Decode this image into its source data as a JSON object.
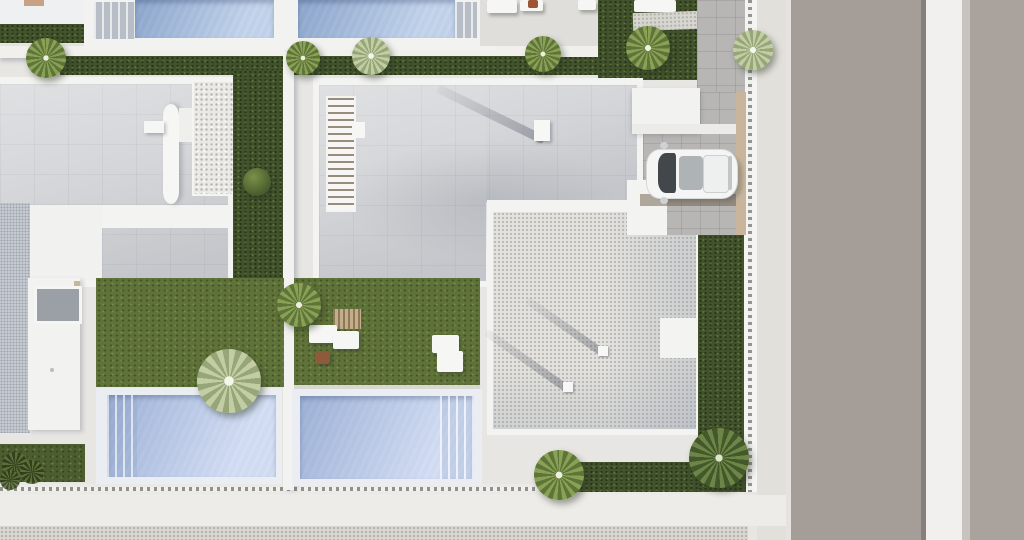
{
  "meta": {
    "title": "Aerial top-down 3D architectural rendering of modern villas with pools, gardens, driveway and street",
    "view": "top-down aerial",
    "render_style": "photorealistic 3D site render"
  },
  "palette": {
    "base": "#e7e6e3",
    "parapet": "#f3f3f1",
    "roof": "#d5d6d9",
    "pool_top": "#a3bcdf",
    "pool_bottom": "#bccced",
    "pool_rim": "#eaedf1",
    "pool_deck": "#c6c9ce",
    "grass": "#5f7239",
    "grass_dark": "#4c5e2f",
    "hedge": "#41522c",
    "road": "#a59d98",
    "road_far": "#aaa29d",
    "median": "#f1f0ee",
    "median_edge": "#c7c4c0",
    "sidewalk": "#e2e0db",
    "gravel_roof": "#e3e2de",
    "gravel_walk": "#d8d6d1",
    "stipple_blue": "#c9cdd3",
    "tiles": "#b8b6b4",
    "canopy": "#f2f2f0",
    "tan_wall": "#c8b59c",
    "tan_accent": "#c9a187",
    "terrace": "#e0dedb",
    "stone": "#eae9e5",
    "stair_wood": "#b3a08b",
    "deck_wood": "#ad9268",
    "stool": "#8d5a3c",
    "accent_red": "#9c5434",
    "car_body": "#f4f5f4",
    "car_glass": "#41474b",
    "car_sunroof": "#aeb4b6",
    "white_soft": "#f1f1ef"
  },
  "objects": {
    "scene": "Aerial view of a modern villa development",
    "street": "Asphalt street with concrete median strip",
    "sidewalk": "Sidewalk along the street",
    "fence": "Perimeter mesh fence on low wall",
    "villa_left": "Left villa flat roof with stair core and stone-clad volume",
    "villa_center": "Center villa flat roof",
    "gravel_terrace": "Gravel-finished lower roof terrace",
    "pool_left_top": "Neighbouring pool, top left",
    "pool_right_top": "Neighbouring pool, top right",
    "pool_left": "Left villa swimming pool",
    "pool_center": "Center villa swimming pool",
    "garden_left": "Left villa lawn",
    "garden_center": "Center villa lawn with outdoor furniture",
    "driveway": "Tiled driveway and parking pad",
    "car": "White car parked on the driveway",
    "loungers": "White sun loungers",
    "palm": "Palm tree",
    "hedge": "Trimmed hedge",
    "skylight": "Glazed skylight on left wing",
    "stairwell": "Open stairwell on center villa roof"
  }
}
